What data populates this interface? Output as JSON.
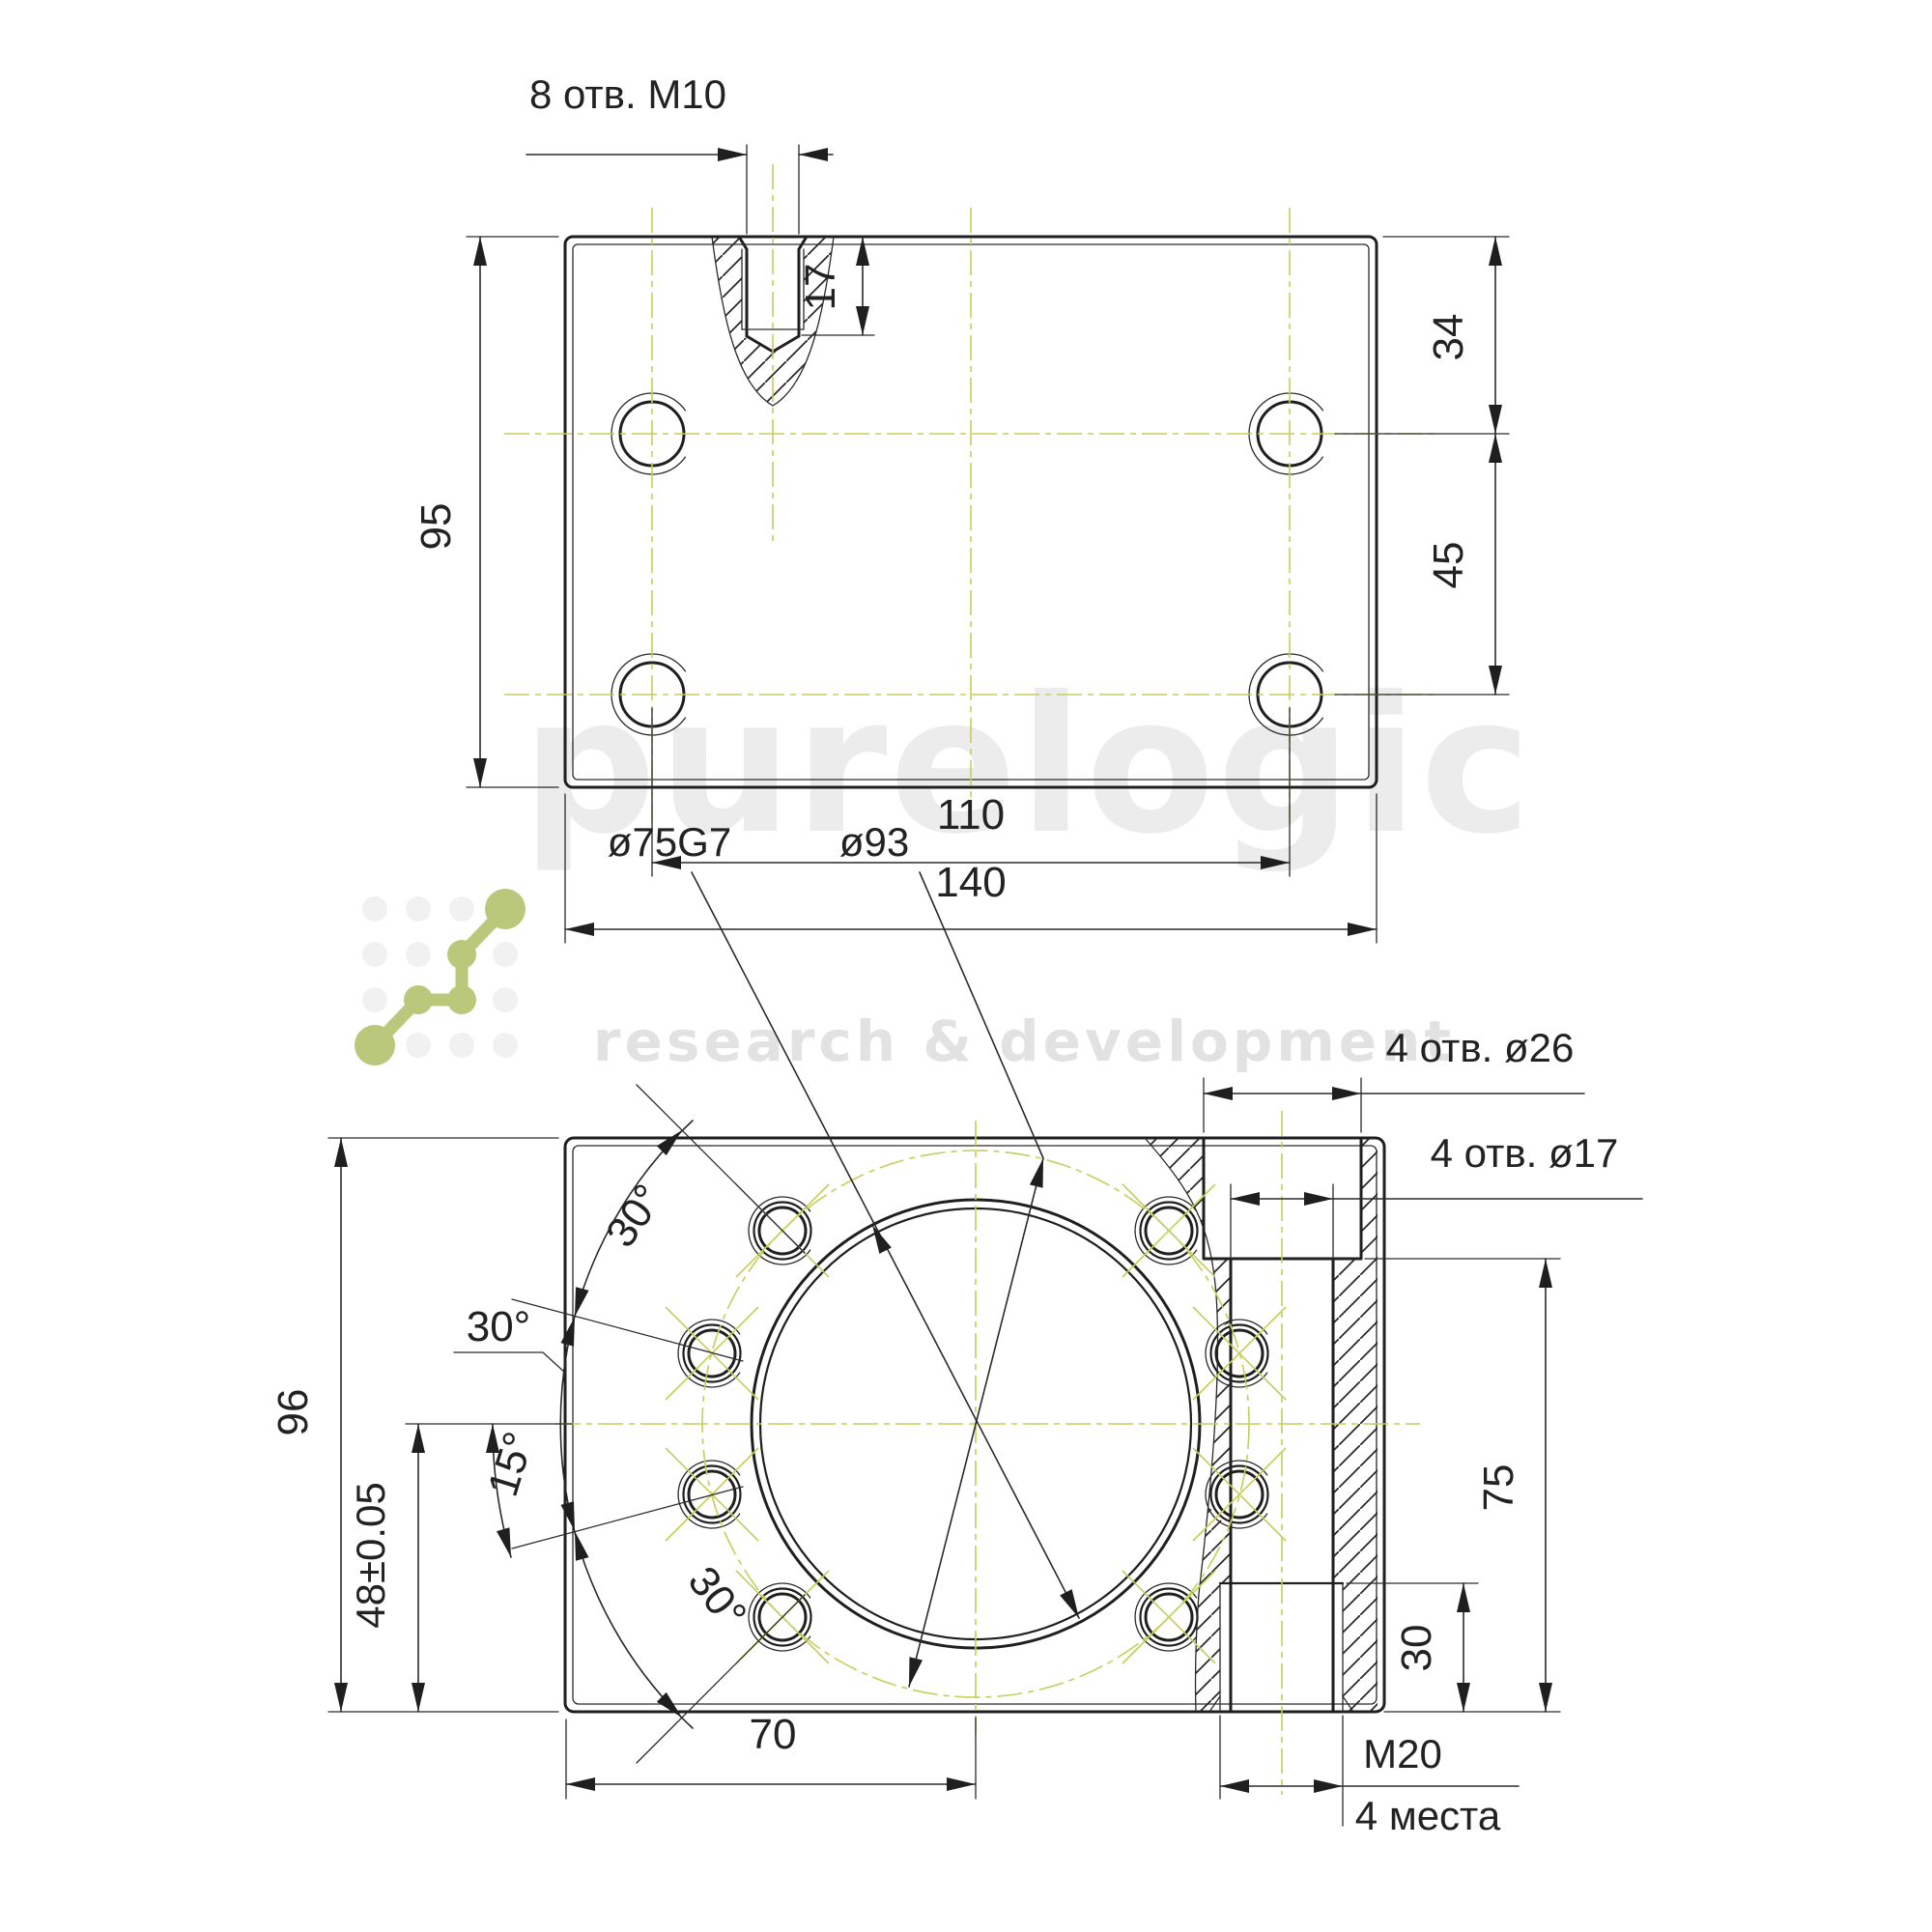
{
  "drawing_title": "Ballscrew end support bracket drawing",
  "colors": {
    "line": "#1f1f1f",
    "centerline_green": "#c3cf5a",
    "logo_green": "#b9c87a",
    "watermark_gray": "#ececec"
  },
  "watermark": {
    "brand": "purelogic",
    "tagline": "research & development"
  },
  "top_view": {
    "labels": {
      "holes_note": "8 отв. M10",
      "thread_depth": "17",
      "height": "95",
      "edge_to_hole": "34",
      "hole_row_spacing": "45",
      "hole_col_spacing": "110",
      "overall_width": "140"
    }
  },
  "front_view": {
    "labels": {
      "bore_dia": "ø75G7",
      "bolt_circle_dia": "ø93",
      "counterbore_note": "4 отв. ø26",
      "through_hole_note": "4 отв. ø17",
      "angle_top": "30°",
      "angle_leader": "30°",
      "angle_small": "15°",
      "angle_bottom": "30°",
      "overall_height": "96",
      "center_height": "48±0.05",
      "center_offset": "70",
      "flange_height": "75",
      "thread_step": "30",
      "side_thread": "M20",
      "side_thread_places": "4 места"
    }
  }
}
